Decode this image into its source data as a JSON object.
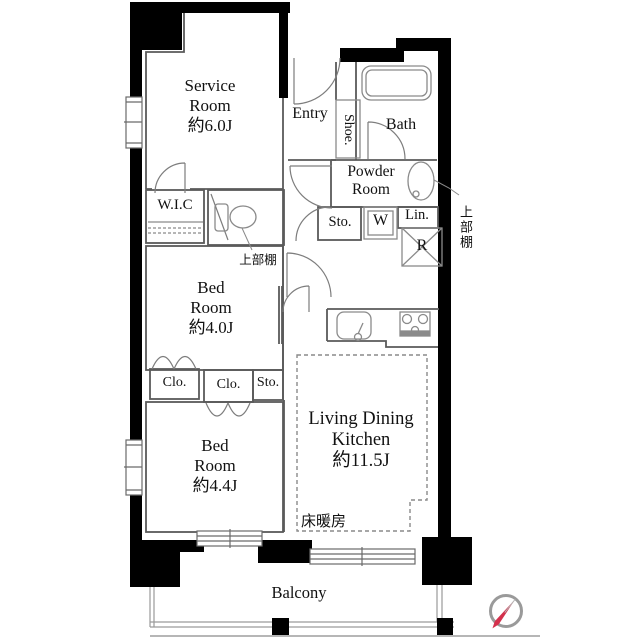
{
  "colors": {
    "wall": "#000000",
    "thin_line": "#5a5a5a",
    "fixture_line": "#8a8a8a",
    "compass_red": "#d4304c",
    "background": "#ffffff"
  },
  "rooms": {
    "service": {
      "name_lines": [
        "Service",
        "Room"
      ],
      "size": "約6.0J"
    },
    "entry": {
      "label": "Entry"
    },
    "shoe": {
      "label": "Shoe."
    },
    "bath": {
      "label": "Bath"
    },
    "powder": {
      "name_lines": [
        "Powder",
        "Room"
      ]
    },
    "storage_upper": {
      "label": "Sto."
    },
    "washer": {
      "label": "W"
    },
    "linen": {
      "label": "Lin."
    },
    "refrigerator": {
      "label": "R"
    },
    "shelf_right": {
      "label": "上部棚"
    },
    "wic": {
      "label": "W.I.C"
    },
    "shelf_toilet": {
      "label": "上部棚"
    },
    "bedroom1": {
      "name_lines": [
        "Bed",
        "Room"
      ],
      "size": "約4.0J"
    },
    "closet1": {
      "label": "Clo."
    },
    "closet2": {
      "label": "Clo."
    },
    "storage_lower": {
      "label": "Sto."
    },
    "bedroom2": {
      "name_lines": [
        "Bed",
        "Room"
      ],
      "size": "約4.4J"
    },
    "ldk": {
      "name_lines": [
        "Living Dining",
        "Kitchen"
      ],
      "size": "約11.5J"
    },
    "floor_heating": {
      "label": "床暖房"
    },
    "balcony": {
      "label": "Balcony"
    }
  }
}
